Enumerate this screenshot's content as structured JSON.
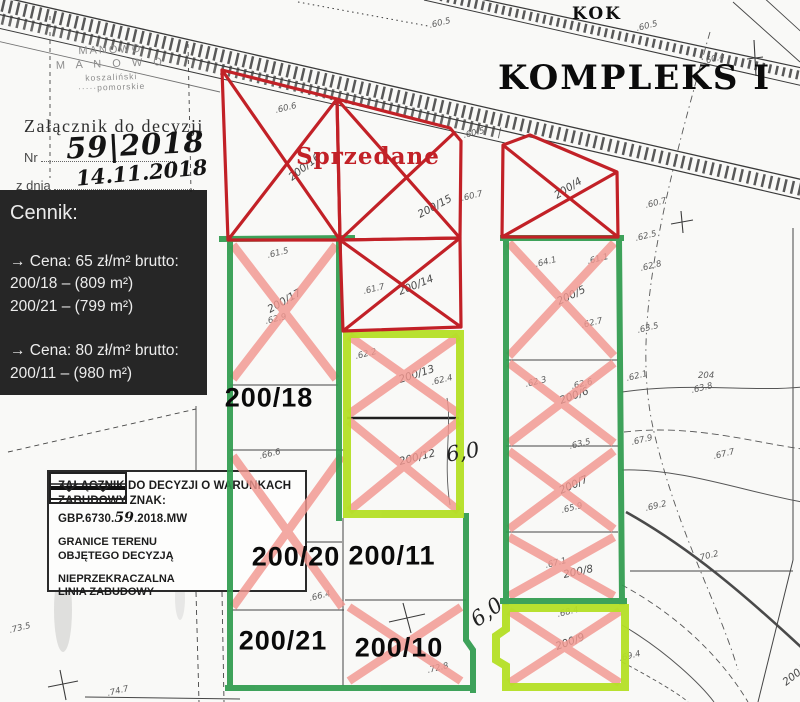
{
  "colors": {
    "sold_red": "#c22127",
    "cross_pink": "#f29790",
    "boundary_green": "#2f9b4d",
    "boundary_lime": "#b4df25",
    "panel_black": "#161616",
    "scan_ink": "#3f3f3f"
  },
  "header": {
    "kok": "KOK",
    "title": "KOMPLEKS I"
  },
  "stamp": {
    "lines": [
      "MANOWO",
      "M A N O W O",
      "koszaliński",
      "·····pomorskie"
    ],
    "attachment_line": "Załącznik do decyzji",
    "nr_label": "Nr",
    "nr_value": "59|2018",
    "date_label": "z dnia",
    "date_value": "14.11.2018"
  },
  "cennik": {
    "title": "Cennik:",
    "sections": [
      {
        "header": "→ Cena: 65 zł/m² brutto:",
        "items": [
          "200/18 – (809 m²)",
          "200/21 – (799 m²)"
        ]
      },
      {
        "header": "→ Cena: 80 zł/m² brutto:",
        "items": [
          "200/11 – (980 m²)"
        ]
      }
    ]
  },
  "legend": {
    "title_line1": "ZAŁĄCZNIK DO DECYZJI O WARUNKACH",
    "title_prefix": "ZABUDOWY ZNAK: GBP.6730.",
    "title_hand": "59",
    "title_suffix": ".2018.MW",
    "items": [
      {
        "label_line1": "GRANICE TERENU",
        "label_line2": "OBJĘTEGO DECYZJĄ"
      },
      {
        "label_line1": "NIEPRZEKRACZALNA",
        "label_line2": "LINIA ZABUDOWY"
      }
    ]
  },
  "map": {
    "sold_label": "Sprzedane",
    "plot_labels": [
      {
        "text": "200/18",
        "x": 269,
        "y": 398
      },
      {
        "text": "200/20",
        "x": 296,
        "y": 557
      },
      {
        "text": "200/11",
        "x": 392,
        "y": 556
      },
      {
        "text": "200/21",
        "x": 283,
        "y": 641
      },
      {
        "text": "200/10",
        "x": 399,
        "y": 648
      }
    ],
    "dim_annotations": [
      {
        "text": "6,0",
        "x": 446,
        "y": 440,
        "rot": -10
      },
      {
        "text": "6,0",
        "x": 470,
        "y": 600,
        "rot": -36
      }
    ],
    "parcel_numbers": [
      {
        "text": "200/16",
        "x": 292,
        "y": 181,
        "rot": -38
      },
      {
        "text": "200/15",
        "x": 420,
        "y": 218,
        "rot": -28
      },
      {
        "text": "200/14",
        "x": 400,
        "y": 295,
        "rot": -22
      },
      {
        "text": "200/17",
        "x": 270,
        "y": 313,
        "rot": -30
      },
      {
        "text": "200/13",
        "x": 400,
        "y": 383,
        "rot": -18
      },
      {
        "text": "200/12",
        "x": 400,
        "y": 465,
        "rot": -14
      },
      {
        "text": "200/4",
        "x": 557,
        "y": 199,
        "rot": -32
      },
      {
        "text": "200/5",
        "x": 559,
        "y": 305,
        "rot": -26
      },
      {
        "text": "200/6",
        "x": 561,
        "y": 404,
        "rot": -20
      },
      {
        "text": "200/7",
        "x": 561,
        "y": 494,
        "rot": -24
      },
      {
        "text": "200/8",
        "x": 564,
        "y": 578,
        "rot": -12
      },
      {
        "text": "200/9",
        "x": 557,
        "y": 650,
        "rot": -20
      },
      {
        "text": "200/3",
        "x": 786,
        "y": 686,
        "rot": -38
      }
    ],
    "elevations": [
      {
        "text": ".60.6",
        "x": 276,
        "y": 113
      },
      {
        "text": ".60.5",
        "x": 430,
        "y": 28
      },
      {
        "text": ".60.5",
        "x": 637,
        "y": 31
      },
      {
        "text": ".60.4",
        "x": 704,
        "y": 64
      },
      {
        "text": ".60.5",
        "x": 464,
        "y": 138
      },
      {
        "text": ".60.7",
        "x": 462,
        "y": 201
      },
      {
        "text": ".60.7",
        "x": 646,
        "y": 208
      },
      {
        "text": ".62.5",
        "x": 636,
        "y": 241
      },
      {
        "text": ".62.8",
        "x": 641,
        "y": 271
      },
      {
        "text": ".63.5",
        "x": 638,
        "y": 333
      },
      {
        "text": ".62.1",
        "x": 627,
        "y": 381
      },
      {
        "text": "204",
        "x": 698,
        "y": 378,
        "rot": 0
      },
      {
        "text": ".63.8",
        "x": 692,
        "y": 393
      },
      {
        "text": ".61.5",
        "x": 268,
        "y": 258
      },
      {
        "text": ".62.9",
        "x": 266,
        "y": 324
      },
      {
        "text": ".61.7",
        "x": 364,
        "y": 294
      },
      {
        "text": ".62.2",
        "x": 356,
        "y": 359
      },
      {
        "text": ".62.4",
        "x": 432,
        "y": 385
      },
      {
        "text": ".66.6",
        "x": 260,
        "y": 459
      },
      {
        "text": ".64.1",
        "x": 536,
        "y": 267
      },
      {
        "text": ".61.1",
        "x": 588,
        "y": 264
      },
      {
        "text": ".62.7",
        "x": 582,
        "y": 328
      },
      {
        "text": ".62.3",
        "x": 526,
        "y": 387
      },
      {
        "text": ".62.6",
        "x": 572,
        "y": 389
      },
      {
        "text": ".63.5",
        "x": 570,
        "y": 449
      },
      {
        "text": ".65.9",
        "x": 562,
        "y": 513
      },
      {
        "text": ".67.1",
        "x": 546,
        "y": 568
      },
      {
        "text": ".68.4",
        "x": 558,
        "y": 617
      },
      {
        "text": ".69.4",
        "x": 620,
        "y": 661
      },
      {
        "text": ".67.9",
        "x": 632,
        "y": 445
      },
      {
        "text": ".67.7",
        "x": 714,
        "y": 459
      },
      {
        "text": ".69.2",
        "x": 646,
        "y": 511
      },
      {
        "text": ".70.2",
        "x": 698,
        "y": 561
      },
      {
        "text": ".66.4",
        "x": 310,
        "y": 601
      },
      {
        "text": ".72.8",
        "x": 428,
        "y": 673
      },
      {
        "text": ".74.7",
        "x": 108,
        "y": 696
      },
      {
        "text": ".73.5",
        "x": 10,
        "y": 633
      }
    ]
  }
}
